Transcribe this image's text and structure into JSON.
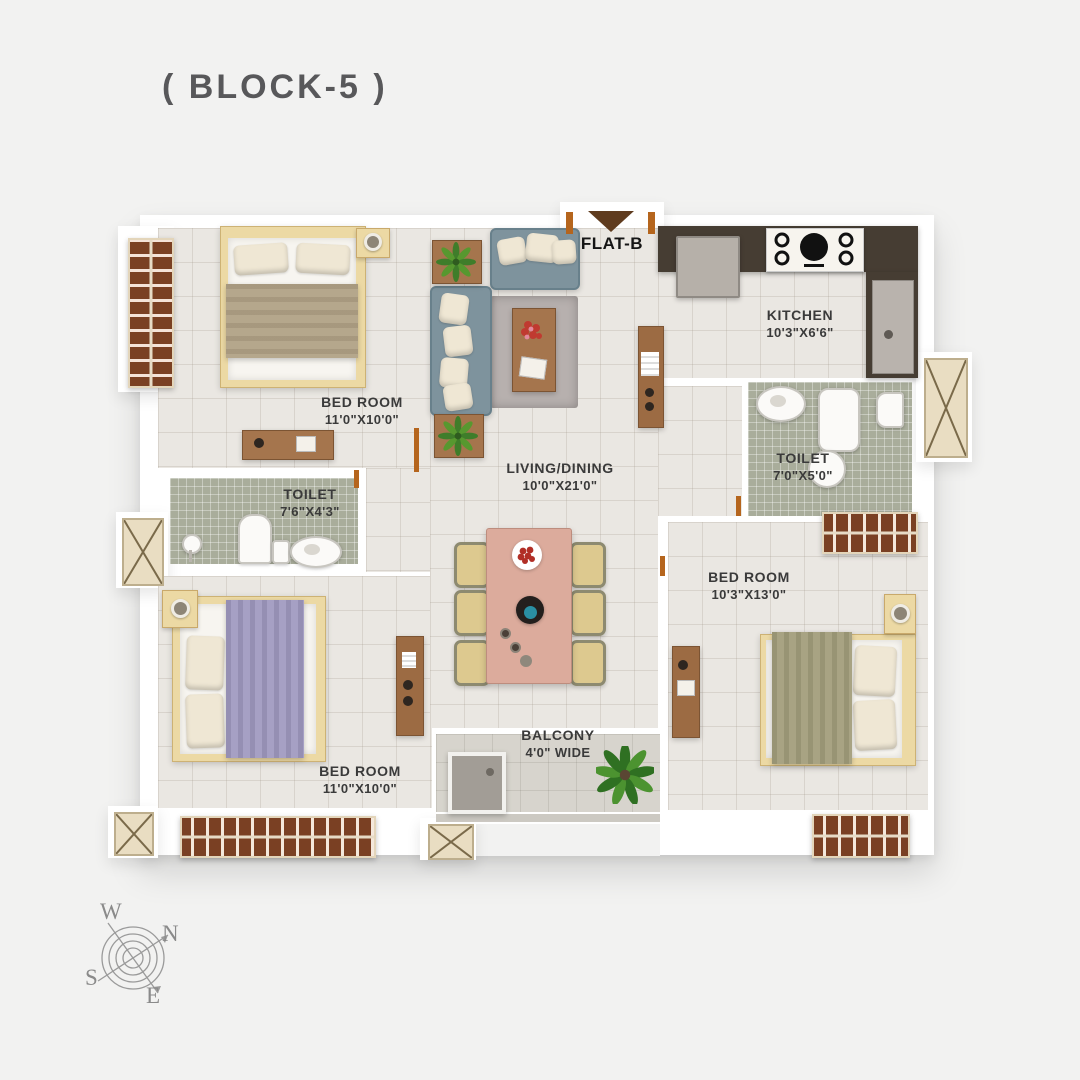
{
  "title": "( BLOCK-5 )",
  "entry": {
    "flat_label": "FLAT-B"
  },
  "rooms": {
    "bedroom_top_left": {
      "name": "BED ROOM",
      "dims": "11'0\"X10'0\""
    },
    "toilet_left": {
      "name": "TOILET",
      "dims": "7'6\"X4'3\""
    },
    "living_dining": {
      "name": "LIVING/DINING",
      "dims": "10'0\"X21'0\""
    },
    "kitchen": {
      "name": "KITCHEN",
      "dims": "10'3\"X6'6\""
    },
    "toilet_right": {
      "name": "TOILET",
      "dims": "7'0\"X5'0\""
    },
    "bedroom_right": {
      "name": "BED ROOM",
      "dims": "10'3\"X13'0\""
    },
    "bedroom_bottom_left": {
      "name": "BED ROOM",
      "dims": "11'0\"X10'0\""
    },
    "balcony": {
      "name": "BALCONY",
      "dims": "4'0\" WIDE"
    }
  },
  "compass": {
    "north": "N",
    "south": "S",
    "east": "E",
    "west": "W"
  },
  "colors": {
    "bg": "#f2f2f1",
    "wall": "#ffffff",
    "floor": "#eae7e2",
    "toilet_floor": "#a9ad9b",
    "balcony_floor": "#d7d4cd",
    "counter": "#463d33",
    "wood": "#a5754d",
    "wardrobe": "#7a4023",
    "door": "#b5651d",
    "sofa": "#7e939d",
    "pillow": "#efe7d4",
    "rug": "#b7b0ae",
    "bed_frame": "#ecd9a4",
    "blanket_tan": "#b5a78c",
    "blanket_purple": "#a6a0c4",
    "blanket_olive": "#a8a383",
    "dining_table": "#dcab9c",
    "chair": "#ddc98f",
    "plant": "#3f7d2a",
    "label": "#3a3a3a",
    "title": "#58585a"
  }
}
